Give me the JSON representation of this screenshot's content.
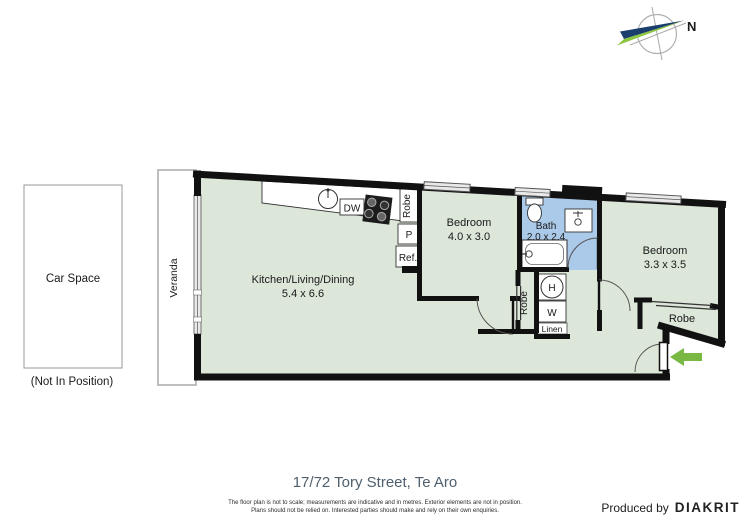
{
  "compass": {
    "north_label": "N"
  },
  "car_space": {
    "label": "Car Space",
    "note": "(Not In Position)"
  },
  "plan": {
    "veranda_label": "Veranda",
    "rooms": {
      "kitchen_living_dining": {
        "name": "Kitchen/Living/Dining",
        "dims": "5.4 x 6.6"
      },
      "bedroom_1": {
        "name": "Bedroom",
        "dims": "4.0 x 3.0"
      },
      "bath": {
        "name": "Bath",
        "dims": "2.0 x 2.4"
      },
      "bedroom_2": {
        "name": "Bedroom",
        "dims": "3.3 x 3.5"
      }
    },
    "fixtures": {
      "dishwasher": "DW",
      "pantry": "P",
      "fridge": "Ref.",
      "robe_bedroom_1": "Robe",
      "robe_hall": "Robe",
      "robe_bedroom_2": "Robe",
      "hot_water": "H",
      "washing_machine": "W",
      "linen": "Linen"
    }
  },
  "footer": {
    "title": "17/72 Tory Street, Te Aro",
    "disclaimer_line_1": "The floor plan is not to scale; measurements are indicative and in metres. Exterior elements are not in position.",
    "disclaimer_line_2": "Plans should not be relied on. Interested parties should make and rely on their own enquiries.",
    "produced_by": "Produced by",
    "brand": "DIAKRIT"
  },
  "colors": {
    "floor": "#dce6d9",
    "bath_floor": "#abc9e8",
    "wall": "#111111",
    "entry_arrow": "#79b843",
    "compass_navy": "#1c3e6e",
    "compass_green": "#8cc63f"
  }
}
